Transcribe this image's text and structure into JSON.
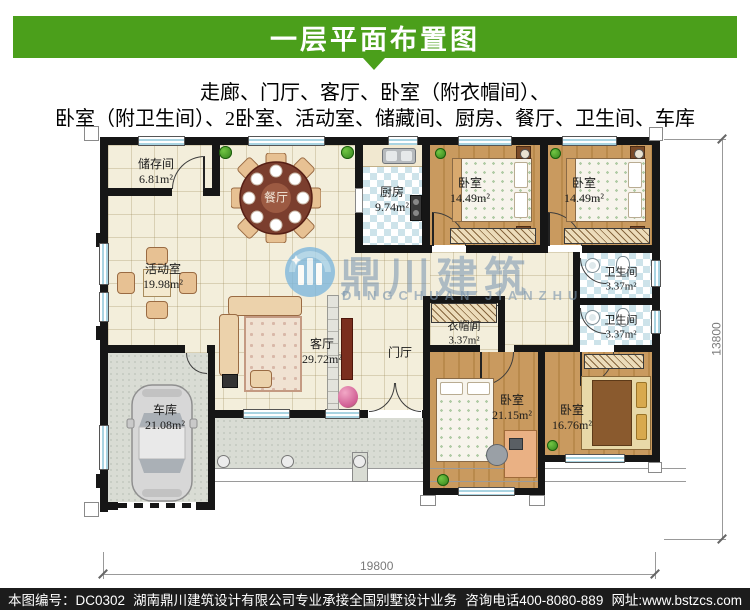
{
  "header": {
    "title": "一层平面布置图"
  },
  "subtitle": {
    "line1": "走廊、门厅、客厅、卧室（附衣帽间）、",
    "line2": "卧室（附卫生间）、2卧室、活动室、储藏间、厨房、餐厅、卫生间、车库"
  },
  "plan": {
    "rooms": [
      {
        "name": "储存间",
        "area": "6.81m²"
      },
      {
        "name": "餐厅",
        "area": ""
      },
      {
        "name": "厨房",
        "area": "9.74m²"
      },
      {
        "name": "卧室",
        "area": "14.49m²"
      },
      {
        "name": "卧室",
        "area": "14.49m²"
      },
      {
        "name": "活动室",
        "area": "19.98m²"
      },
      {
        "name": "卫生间",
        "area": "3.37m²"
      },
      {
        "name": "卫生间",
        "area": "3.37m²"
      },
      {
        "name": "衣帽间",
        "area": "3.37m²"
      },
      {
        "name": "客厅",
        "area": "29.72m²"
      },
      {
        "name": "门厅",
        "area": ""
      },
      {
        "name": "车库",
        "area": "21.08m²"
      },
      {
        "name": "卧室",
        "area": "21.15m²"
      },
      {
        "name": "卧室",
        "area": "16.76m²"
      }
    ],
    "dimensions": {
      "width": "19800",
      "height": "13800"
    }
  },
  "watermark": {
    "name_cn": "鼎川建筑",
    "name_en": "DINGCHUAN JIANZHU"
  },
  "footer": {
    "drawing_no": "本图编号：DC0302",
    "company": "湖南鼎川建筑设计有限公司专业承接全国别墅设计业务",
    "phone": "咨询电话400-8080-889",
    "website": "网址:www.bstzcs.com"
  },
  "colors": {
    "header_green": "#4b9f1b",
    "wall": "#161616",
    "footer_bg": "#1c1c1c"
  }
}
